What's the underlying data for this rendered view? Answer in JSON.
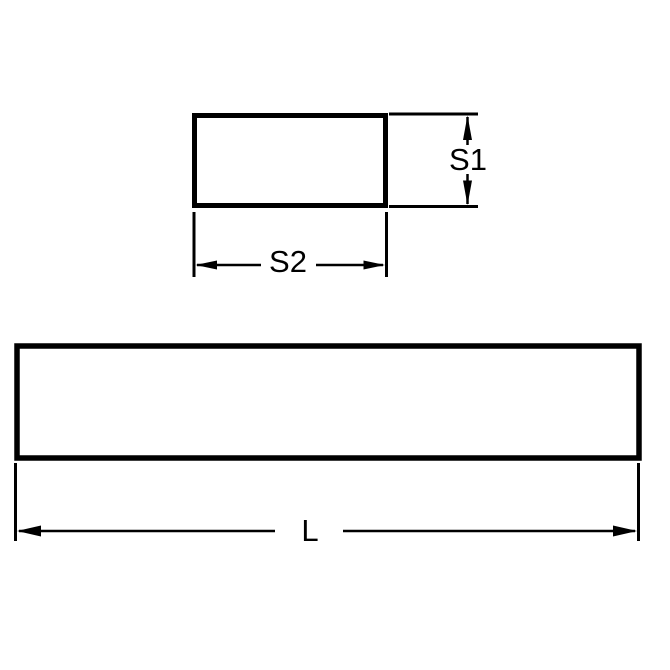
{
  "diagram": {
    "background_color": "#ffffff",
    "line_color": "#000000",
    "cross_section_view": {
      "height_label": "S1",
      "width_label": "S2"
    },
    "side_view": {
      "length_label": "L"
    }
  }
}
